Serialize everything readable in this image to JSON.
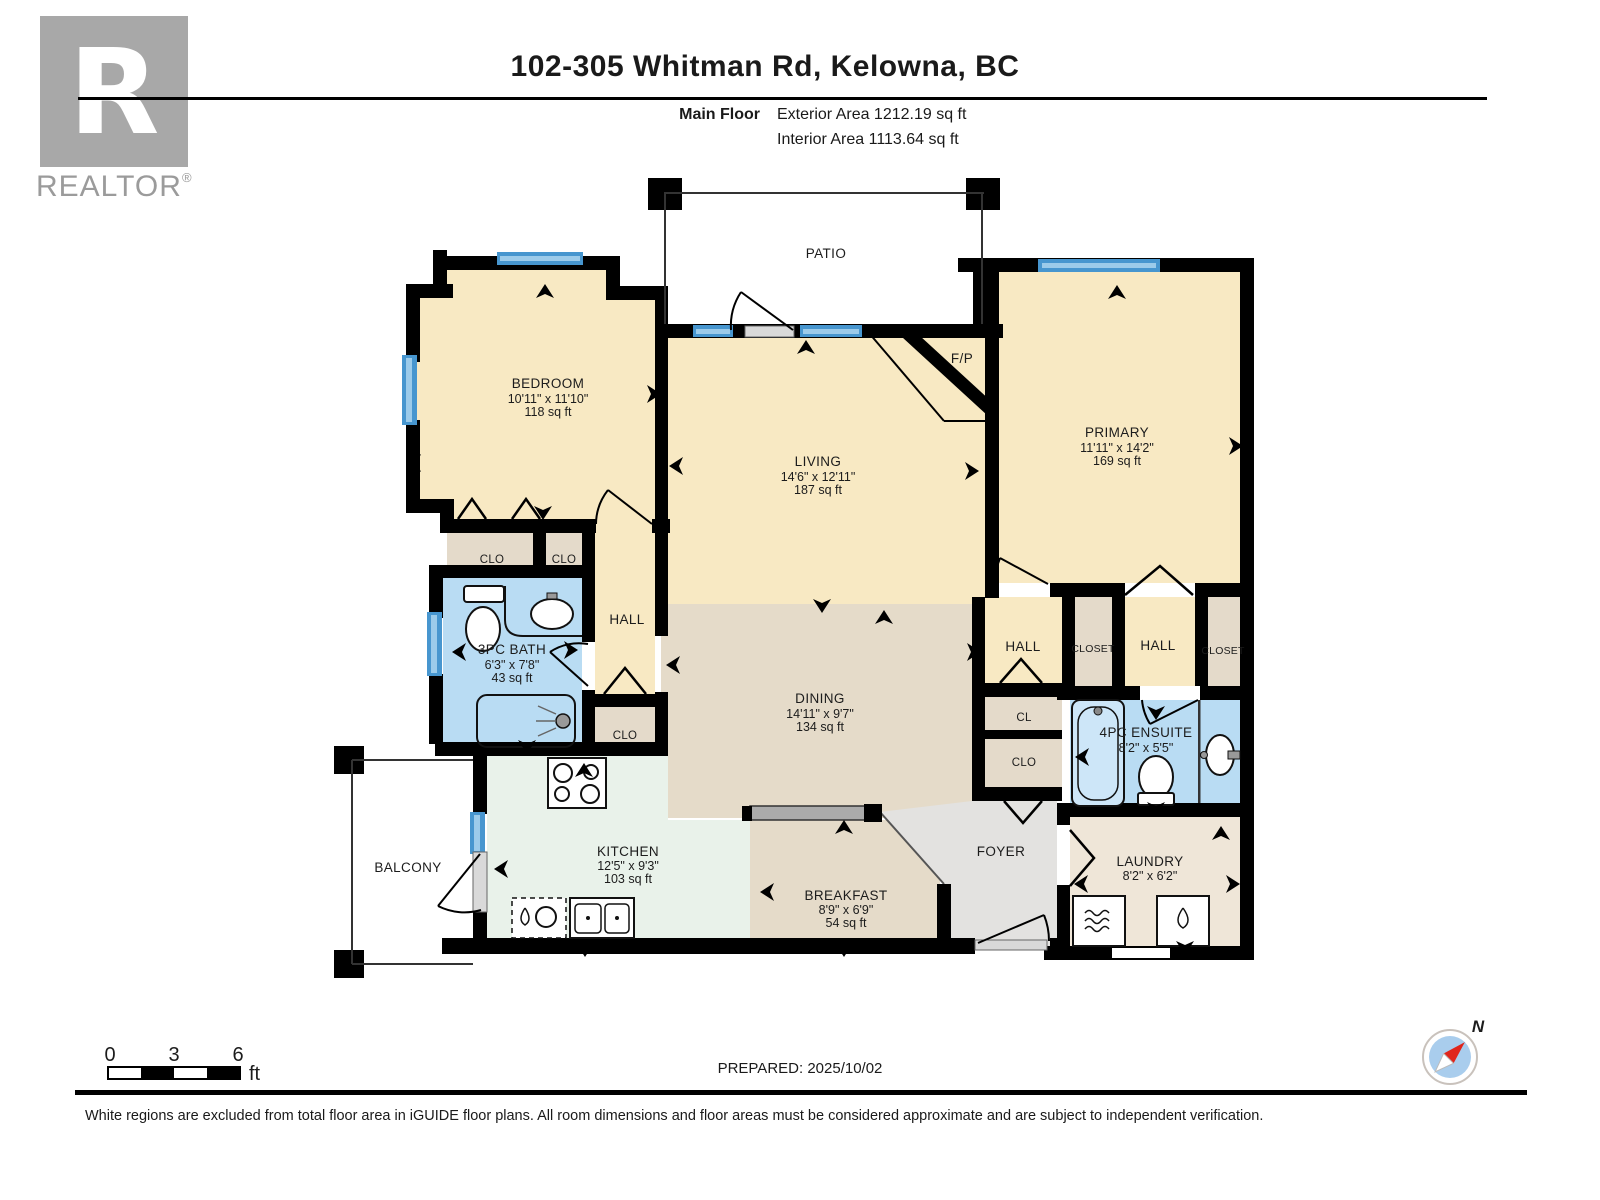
{
  "header": {
    "logo_letter": "R",
    "logo_word": "REALTOR",
    "logo_reg": "®",
    "title": "102-305 Whitman Rd, Kelowna, BC",
    "floor_label": "Main Floor",
    "exterior_area": "Exterior Area 1212.19 sq ft",
    "interior_area": "Interior Area 1113.64 sq ft"
  },
  "rooms": {
    "patio": {
      "name": "PATIO"
    },
    "bedroom": {
      "name": "BEDROOM",
      "dims": "10'11\" x 11'10\"",
      "area": "118 sq ft"
    },
    "living": {
      "name": "LIVING",
      "dims": "14'6\" x 12'11\"",
      "area": "187 sq ft"
    },
    "fireplace": {
      "name": "F/P"
    },
    "primary": {
      "name": "PRIMARY",
      "dims": "11'11\" x 14'2\"",
      "area": "169 sq ft"
    },
    "clo1": {
      "name": "CLO"
    },
    "clo2": {
      "name": "CLO"
    },
    "hall_left": {
      "name": "HALL"
    },
    "bath": {
      "name": "3PC BATH",
      "dims": "6'3\" x 7'8\"",
      "area": "43 sq ft"
    },
    "clo3": {
      "name": "CLO"
    },
    "dining": {
      "name": "DINING",
      "dims": "14'11\" x 9'7\"",
      "area": "134 sq ft"
    },
    "hall1": {
      "name": "HALL"
    },
    "closet1": {
      "name": "CLOSET"
    },
    "hall2": {
      "name": "HALL"
    },
    "closet2": {
      "name": "CLOSET"
    },
    "cl": {
      "name": "CL"
    },
    "clo4": {
      "name": "CLO"
    },
    "ensuite": {
      "name": "4PC ENSUITE",
      "dims": "8'2\" x 5'5\""
    },
    "balcony": {
      "name": "BALCONY"
    },
    "kitchen": {
      "name": "KITCHEN",
      "dims": "12'5\" x 9'3\"",
      "area": "103 sq ft"
    },
    "breakfast": {
      "name": "BREAKFAST",
      "dims": "8'9\" x 6'9\"",
      "area": "54 sq ft"
    },
    "foyer": {
      "name": "FOYER"
    },
    "laundry": {
      "name": "LAUNDRY",
      "dims": "8'2\" x 6'2\""
    }
  },
  "scale_bar": {
    "tick0": "0",
    "tick1": "3",
    "tick2": "6",
    "unit": "ft"
  },
  "compass": {
    "north": "N"
  },
  "footer": {
    "prepared": "PREPARED: 2025/10/02",
    "disclaimer": "White regions are excluded from total floor area in iGUIDE floor plans. All room dimensions and floor areas must be considered approximate and are subject to independent verification."
  },
  "colors": {
    "room_cream": "#F8E9C3",
    "closet_tan": "#E4DACA",
    "dining_tan": "#E5DBC9",
    "kitchen_mint": "#E9F2EA",
    "bath_blue": "#B9DCF3",
    "foyer_gray": "#E3E2E0",
    "laundry_beige": "#EFE6D8",
    "window_blue": "#4796CF",
    "wall_black": "#000000"
  }
}
